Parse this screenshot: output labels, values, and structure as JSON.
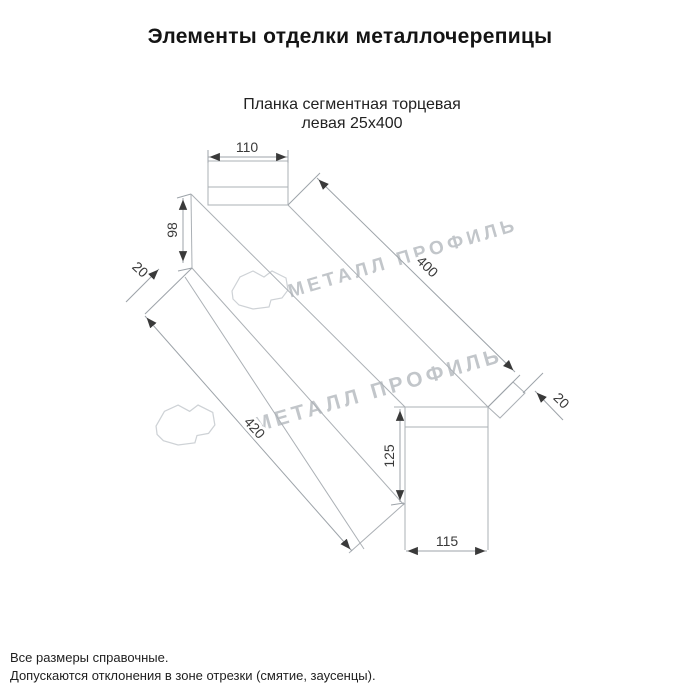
{
  "page": {
    "title": "Элементы отделки металлочерепицы",
    "product": {
      "line1": "Планка сегментная торцевая",
      "line2": "левая 25х400"
    }
  },
  "dimensions": {
    "top_width": "110",
    "left_end_height": "98",
    "left_end_hem": "20",
    "top_edge_length": "400",
    "right_end_hem": "20",
    "bottom_edge_length": "420",
    "right_end_height": "125",
    "right_end_width": "115"
  },
  "watermark": {
    "text": "МЕТАЛЛ ПРОФИЛЬ"
  },
  "colors": {
    "drawing_line": "#abb0b5",
    "dimension_text": "#3a3a3a",
    "watermark_text": "#c2c6ca",
    "title_text": "#141414"
  },
  "footer": {
    "note1": "Все размеры справочные.",
    "note2": "Допускаются отклонения в зоне отрезки (смятие, заусенцы)."
  }
}
